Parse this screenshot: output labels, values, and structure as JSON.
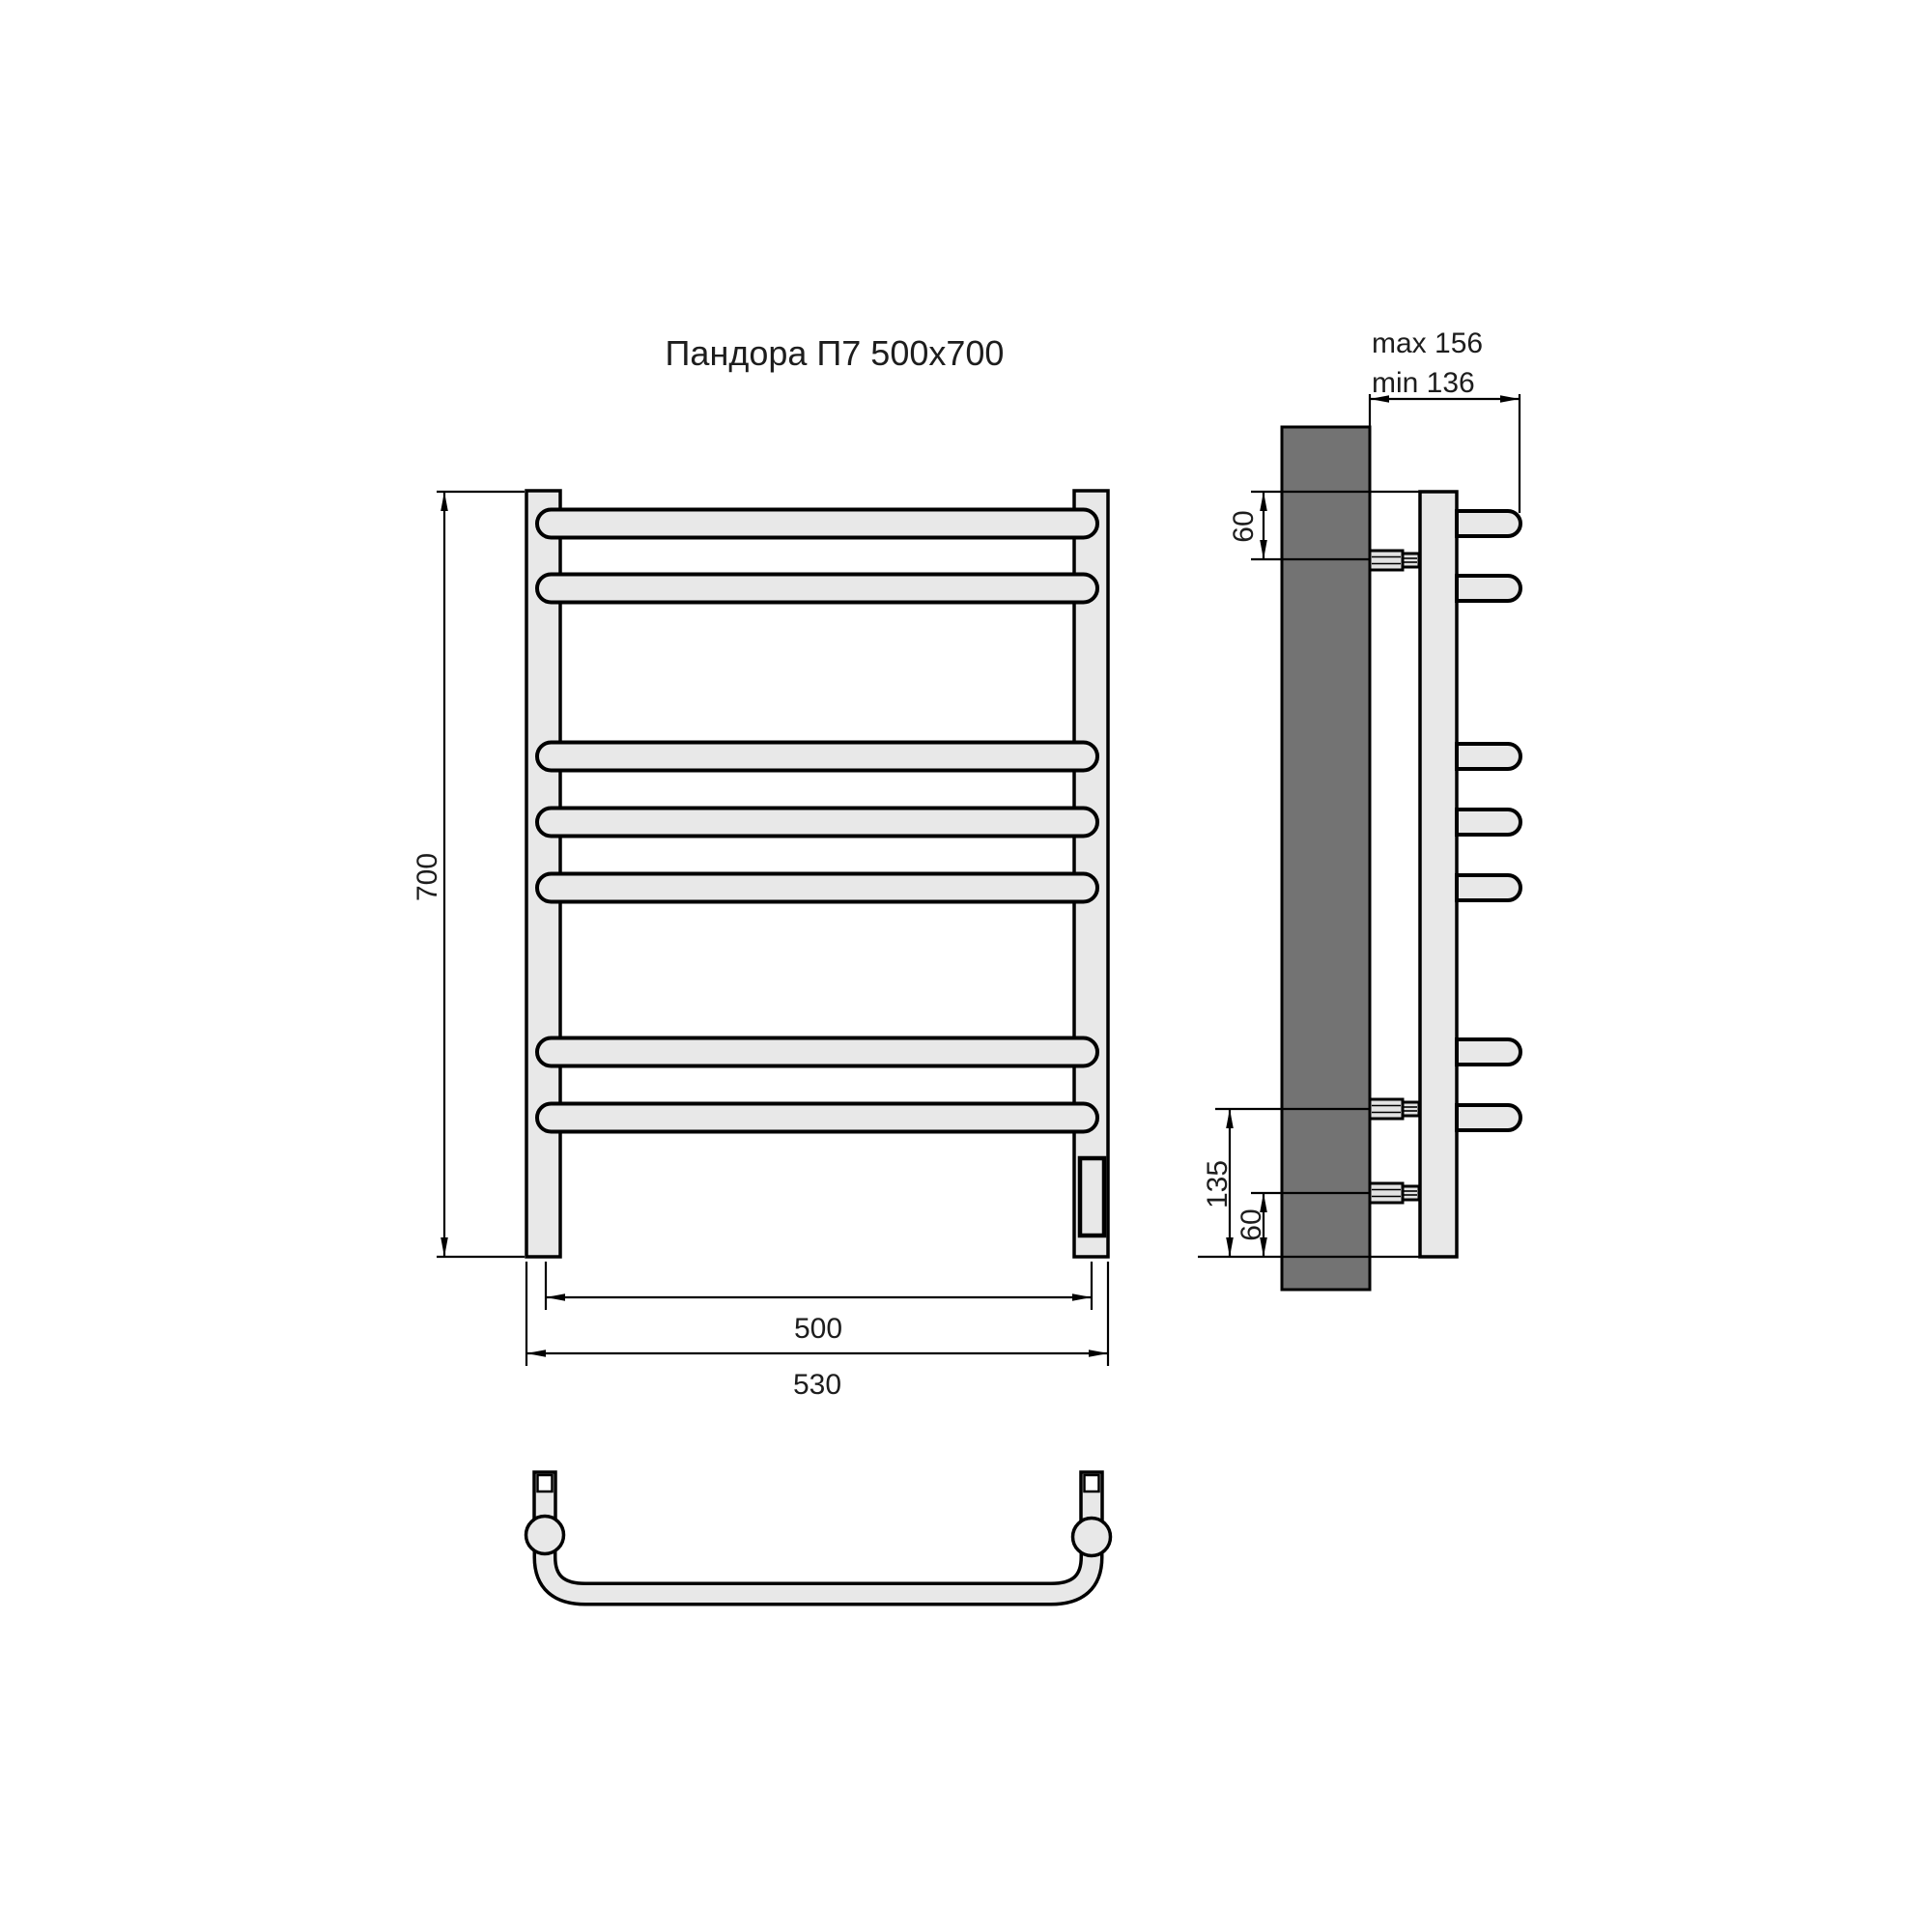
{
  "title": "Пандора П7 500x700",
  "dimensions": {
    "front": {
      "height": "700",
      "rail_width": "500",
      "overall_width": "530"
    },
    "side": {
      "depth_max": "max 156",
      "depth_min": "min 136",
      "top_bracket_offset": "60",
      "bottom_bracket_span": "135",
      "bottom_bracket_offset": "60"
    }
  },
  "structure": {
    "bar_count": 7,
    "views": [
      "front",
      "side",
      "bottom"
    ]
  },
  "colors": {
    "background": "#ffffff",
    "line": "#000000",
    "tube_fill": "#e8e8e8",
    "wall_fill": "#737373",
    "bracket_fill": "#e2e2e2",
    "text": "#1d1d1d"
  }
}
